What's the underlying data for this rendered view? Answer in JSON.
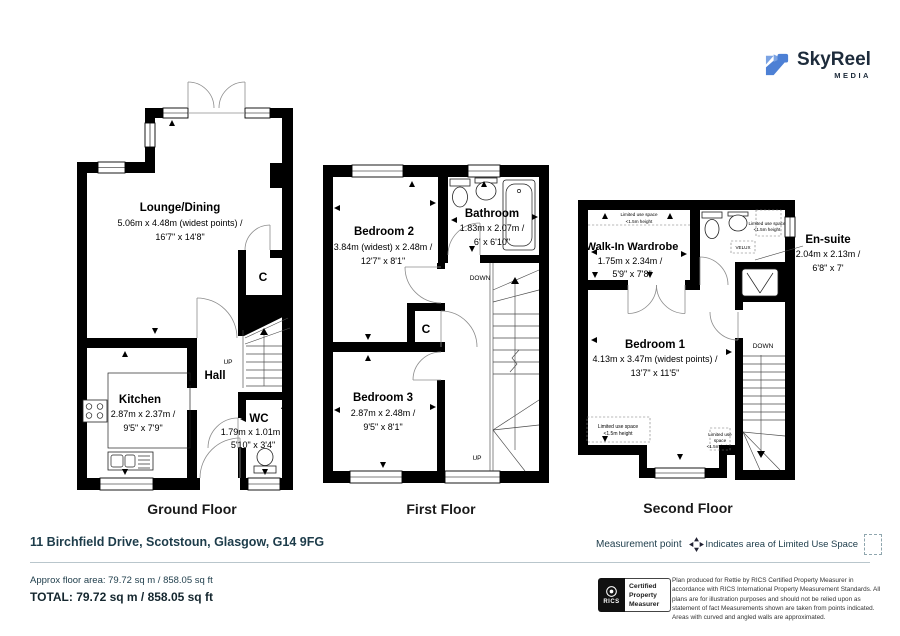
{
  "logo": {
    "name": "SkyReel",
    "media": "MEDIA"
  },
  "floors": {
    "ground": {
      "label": "Ground Floor",
      "lounge": {
        "name": "Lounge/Dining",
        "m": "5.06m x 4.48m (widest points) /",
        "i": "16'7\" x 14'8\""
      },
      "kitchen": {
        "name": "Kitchen",
        "m": "2.87m x 2.37m /",
        "i": "9'5\" x 7'9\""
      },
      "hall": "Hall",
      "wc": {
        "name": "WC",
        "m": "1.79m x 1.01m /",
        "i": "5'10\" x 3'4\""
      },
      "closet": "C",
      "up": "UP"
    },
    "first": {
      "label": "First Floor",
      "bedroom2": {
        "name": "Bedroom 2",
        "m": "3.84m (widest) x 2.48m /",
        "i": "12'7\" x 8'1\""
      },
      "bathroom": {
        "name": "Bathroom",
        "m": "1.83m x 2.07m /",
        "i": "6' x 6'10\""
      },
      "bedroom3": {
        "name": "Bedroom 3",
        "m": "2.87m x 2.48m /",
        "i": "9'5\" x 8'1\""
      },
      "closet": "C",
      "down": "DOWN",
      "up": "UP"
    },
    "second": {
      "label": "Second Floor",
      "wardrobe": {
        "name": "Walk-In Wardrobe",
        "m": "1.75m x 2.34m /",
        "i": "5'9\" x 7'8\""
      },
      "ensuite": {
        "name": "En-suite",
        "m": "2.04m x 2.13m /",
        "i": "6'8\" x 7'"
      },
      "bedroom1": {
        "name": "Bedroom 1",
        "m": "4.13m x 3.47m (widest points) /",
        "i": "13'7\" x 11'5\""
      },
      "velux": "VELUX",
      "down": "DOWN",
      "lus1": "Limited use space",
      "lus2": "<1.5m height",
      "lus_a": "Limited use",
      "lus_b": "space"
    }
  },
  "footer": {
    "address": "11 Birchfield Drive, Scotstoun, Glasgow, G14 9FG",
    "legend_measurement": "Measurement point",
    "legend_lus": "Indicates area of  Limited Use Space",
    "approx": "Approx floor area: 79.72 sq m / 858.05 sq ft",
    "total": "TOTAL: 79.72 sq m / 858.05 sq ft",
    "rics": "RICS",
    "rics_label": "Certified Property Measurer",
    "disclaimer": "Plan produced for Rettie by RICS Certified Property Measurer in accordance with RICS International Property  Measurement Standards.  All plans are for illustration purposes and should not be relied upon as statement of fact Measurements shown are taken from points indicated. Areas with curved and angled walls are approximated.",
    "icons": {
      "measurement": "cross-arrows",
      "lus": "dashed-square"
    }
  },
  "colors": {
    "wall": "#000000",
    "logo_blue": "#4d80d5",
    "logo_blue_light": "#7ba3e3",
    "brand_text": "#1d2b3b",
    "footer_teal": "#1d3c4a",
    "divider": "#b9c6cc"
  }
}
